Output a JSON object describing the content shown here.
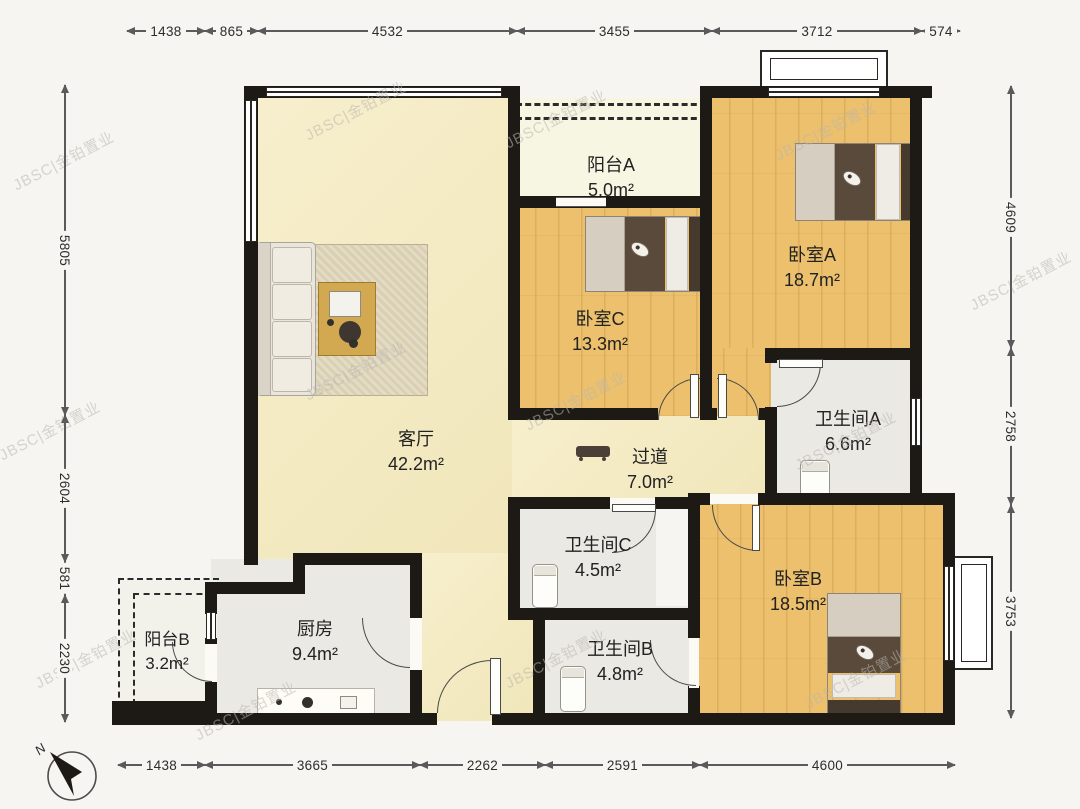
{
  "rooms": {
    "balcony_a": {
      "name": "阳台A",
      "area": "5.0m²"
    },
    "bedroom_a": {
      "name": "卧室A",
      "area": "18.7m²"
    },
    "bedroom_c": {
      "name": "卧室C",
      "area": "13.3m²"
    },
    "living": {
      "name": "客厅",
      "area": "42.2m²"
    },
    "hallway": {
      "name": "过道",
      "area": "7.0m²"
    },
    "bath_a": {
      "name": "卫生间A",
      "area": "6.6m²"
    },
    "bath_c": {
      "name": "卫生间C",
      "area": "4.5m²"
    },
    "bath_b": {
      "name": "卫生间B",
      "area": "4.8m²"
    },
    "bedroom_b": {
      "name": "卧室B",
      "area": "18.5m²"
    },
    "kitchen": {
      "name": "厨房",
      "area": "9.4m²"
    },
    "balcony_b": {
      "name": "阳台B",
      "area": "3.2m²"
    }
  },
  "dims": {
    "top": [
      "1438",
      "865",
      "4532",
      "3455",
      "3712",
      "574"
    ],
    "left": [
      "5805",
      "2604",
      "581",
      "2230"
    ],
    "right": [
      "4609",
      "2758",
      "3753"
    ],
    "bottom": [
      "1438",
      "3665",
      "2262",
      "2591",
      "4600"
    ]
  },
  "compass": {
    "north_label": "N"
  },
  "watermark": {
    "text": "JBSC|金铂置业"
  },
  "colors": {
    "wall": "#1d1915",
    "wood_floor": "#ecc06c",
    "living_floor": "#f5ecc6",
    "tile_floor": "#ebe9e4",
    "balcony_floor": "#f7f6e2",
    "dim_text": "#2d2d2d"
  }
}
